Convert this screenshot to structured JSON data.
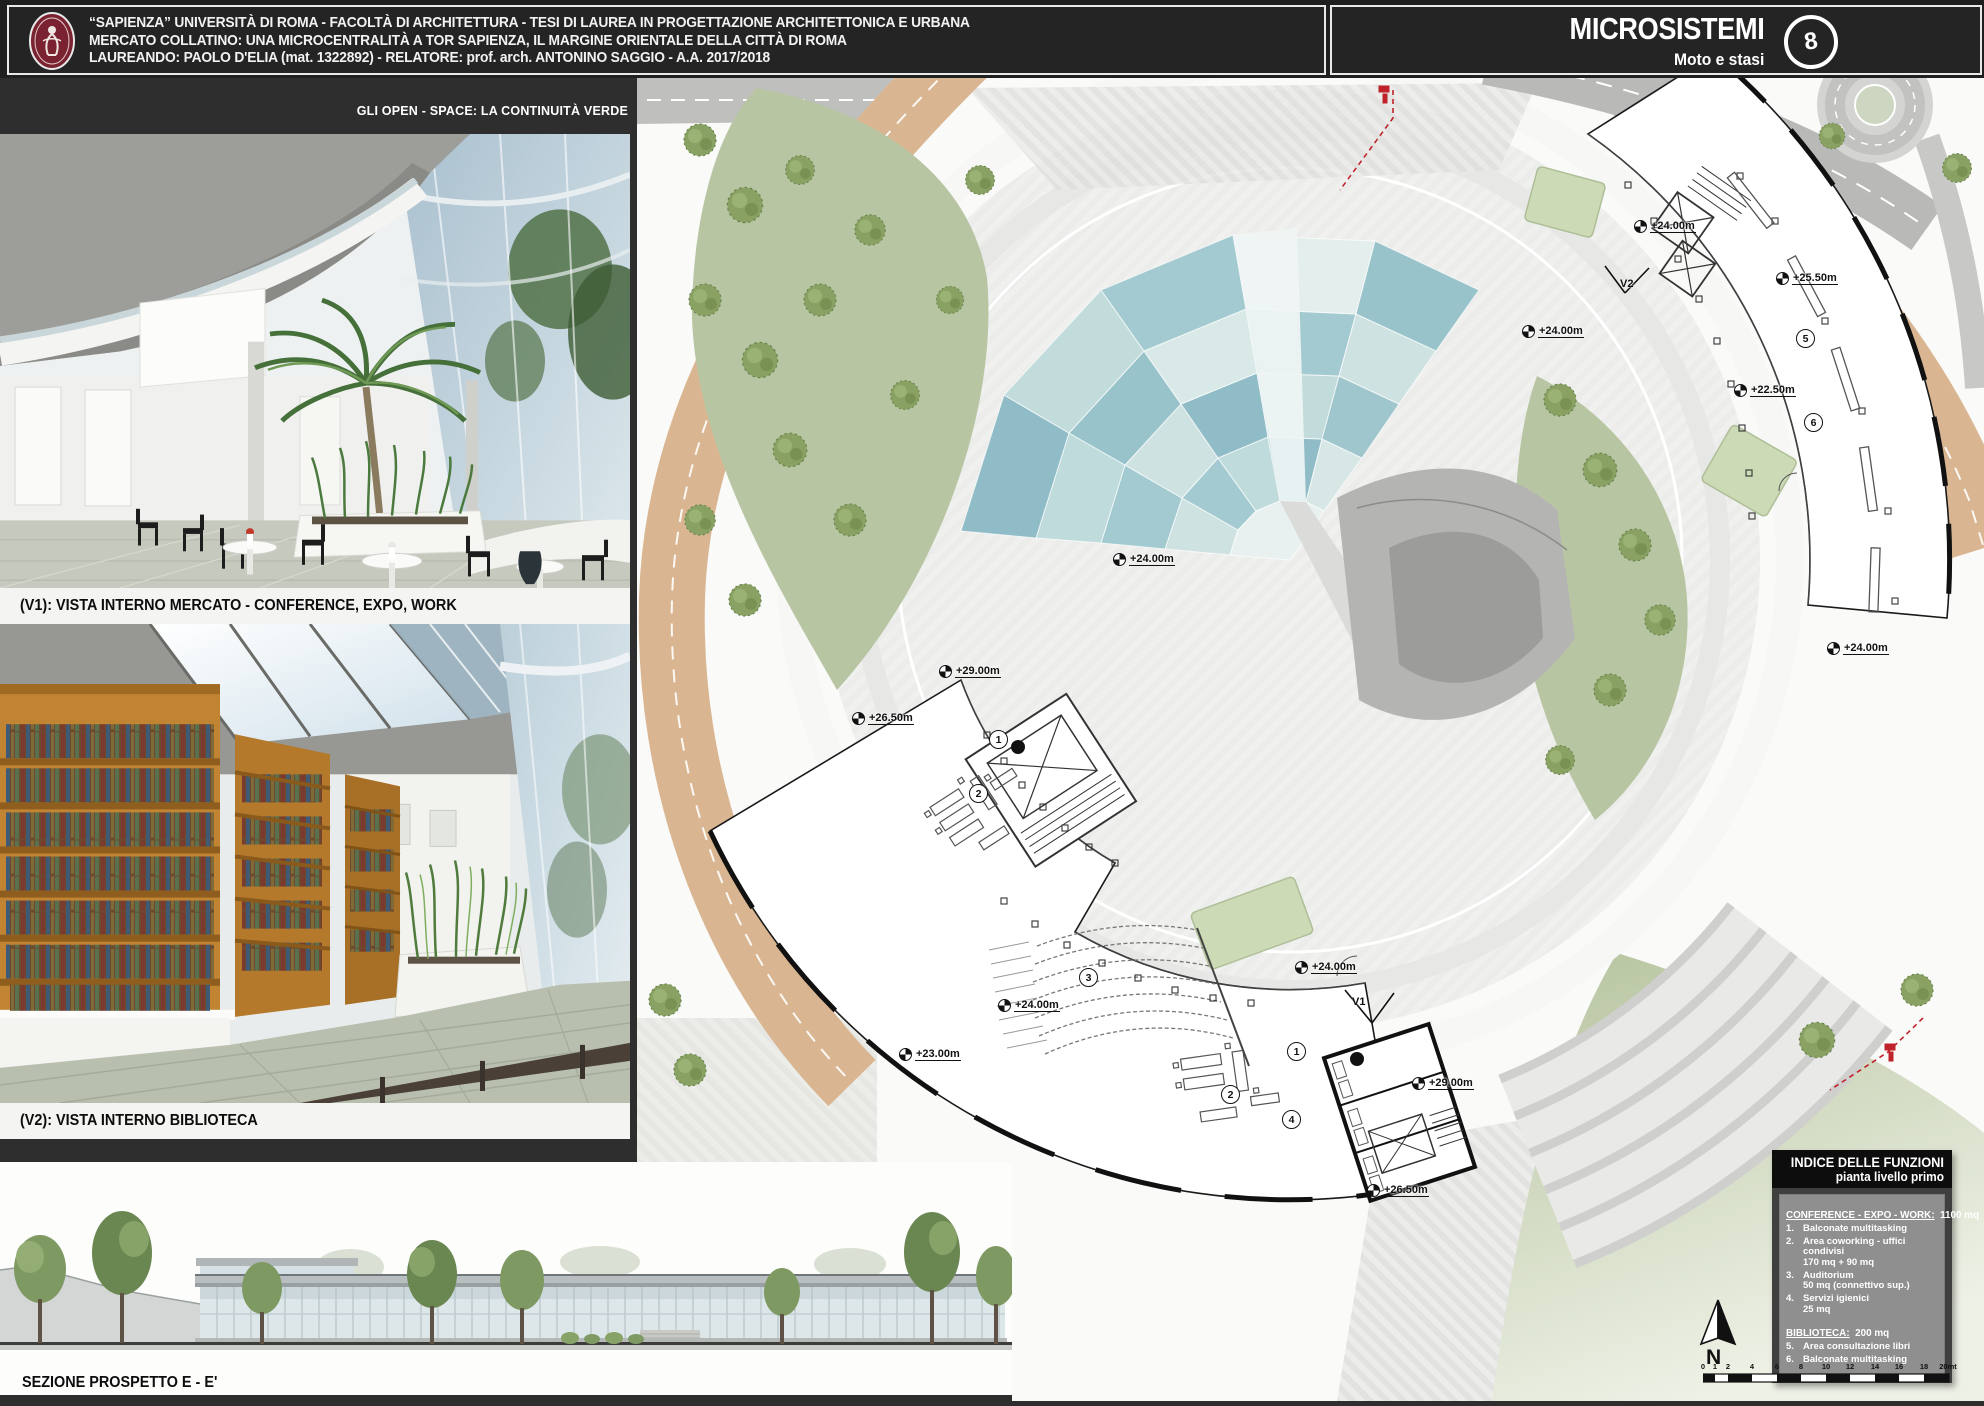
{
  "header": {
    "line1": "“SAPIENZA” UNIVERSITÀ DI ROMA  -  FACOLTÀ DI ARCHITETTURA - TESI DI LAUREA IN PROGETTAZIONE ARCHITETTONICA E URBANA",
    "line2": "MERCATO COLLATINO:  UNA MICROCENTRALITÀ A TOR SAPIENZA, IL MARGINE ORIENTALE DELLA CITTÀ DI ROMA",
    "line3": "LAUREANDO: PAOLO D'ELIA (mat. 1322892)  -  RELATORE: prof. arch. ANTONINO SAGGIO  -  A.A. 2017/2018",
    "right_title": "MICROSISTEMI",
    "right_subtitle": "Moto e stasi",
    "badge": "8"
  },
  "captions": {
    "open_space": "GLI OPEN - SPACE: LA CONTINUITÀ VERDE",
    "v1": "(V1): VISTA INTERNO MERCATO - CONFERENCE, EXPO, WORK",
    "v2": "(V2): VISTA INTERNO BIBLIOTECA",
    "section": "SEZIONE PROSPETTO E - E'"
  },
  "plan": {
    "elevations": [
      "+24.00m",
      "+25.50m",
      "+22.50m",
      "+24.00m",
      "+24.00m",
      "+24.00m",
      "+29.00m",
      "+26.50m",
      "+24.00m",
      "+24.00m",
      "+23.00m",
      "+29.00m",
      "+26.50m"
    ],
    "markers": [
      "1",
      "2",
      "3",
      "2",
      "1",
      "4",
      "5",
      "6"
    ],
    "views": [
      "V1",
      "V2"
    ],
    "north_label": "N"
  },
  "legend": {
    "title1": "INDICE DELLE FUNZIONI",
    "title2": "pianta livello primo",
    "sections": [
      {
        "heading": "CONFERENCE - EXPO - WORK:",
        "area": "1100 mq",
        "items": [
          {
            "num": "1.",
            "name": "Balconate multitasking",
            "detail": ""
          },
          {
            "num": "2.",
            "name": "Area coworking - uffici condivisi",
            "detail": "170 mq + 90 mq"
          },
          {
            "num": "3.",
            "name": "Auditorium",
            "detail": "50 mq (connettivo sup.)"
          },
          {
            "num": "4.",
            "name": "Servizi igienici",
            "detail": "25 mq"
          }
        ]
      },
      {
        "heading": "BIBLIOTECA:",
        "area": "200 mq",
        "items": [
          {
            "num": "5.",
            "name": "Area consultazione libri",
            "detail": ""
          },
          {
            "num": "6.",
            "name": "Balconate multitasking",
            "detail": ""
          }
        ]
      }
    ]
  },
  "scalebar": {
    "ticks": [
      "0",
      "1",
      "2",
      "4",
      "6",
      "8",
      "10",
      "12",
      "14",
      "16",
      "18",
      "20mt"
    ]
  },
  "colors": {
    "accent_red": "#c0222a",
    "sapienza_maroon": "#7b2230",
    "road_beige": "#d9b691",
    "water_teal": "#9fc6cc",
    "lawn_green": "#b8c5a3"
  }
}
